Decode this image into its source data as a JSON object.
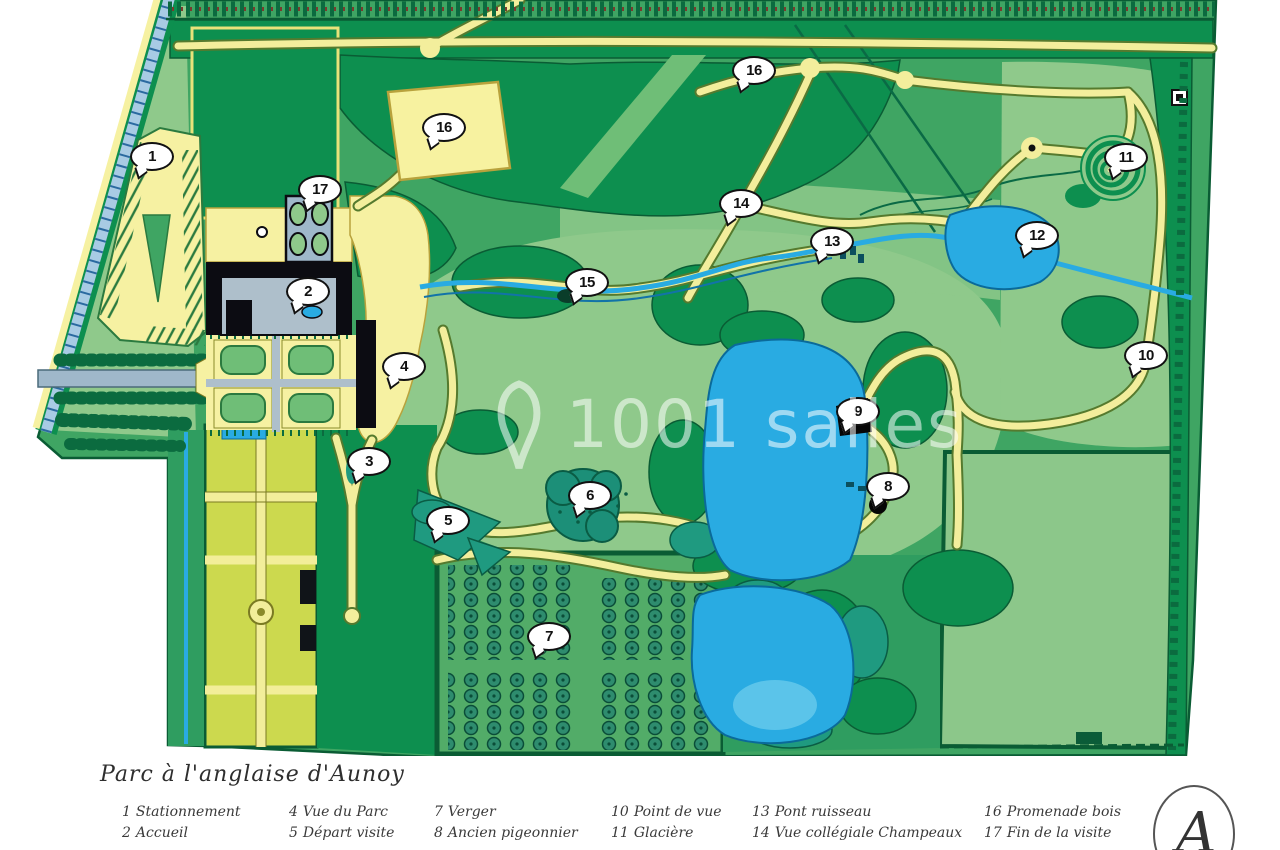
{
  "watermark": {
    "text": "1001 salles",
    "icon": "location-pin"
  },
  "legend": {
    "title": "Parc à l'anglaise d'Aunoy",
    "columns": [
      {
        "items": [
          {
            "num": "1",
            "label": "Stationnement"
          },
          {
            "num": "2",
            "label": "Accueil"
          }
        ]
      },
      {
        "items": [
          {
            "num": "4",
            "label": "Vue du Parc"
          },
          {
            "num": "5",
            "label": "Départ visite"
          }
        ]
      },
      {
        "items": [
          {
            "num": "7",
            "label": "Verger"
          },
          {
            "num": "8",
            "label": "Ancien pigeonnier"
          }
        ]
      },
      {
        "items": [
          {
            "num": "10",
            "label": "Point de vue"
          },
          {
            "num": "11",
            "label": "Glacière"
          }
        ]
      },
      {
        "items": [
          {
            "num": "13",
            "label": "Pont ruisseau"
          },
          {
            "num": "14",
            "label": "Vue collégiale Champeaux"
          }
        ]
      },
      {
        "items": [
          {
            "num": "16",
            "label": "Promenade bois"
          },
          {
            "num": "17",
            "label": "Fin de la visite"
          }
        ]
      }
    ]
  },
  "logo": {
    "letter": "A"
  },
  "markers": [
    {
      "num": "1",
      "x": 152,
      "y": 157
    },
    {
      "num": "16",
      "x": 444,
      "y": 128
    },
    {
      "num": "17",
      "x": 320,
      "y": 190
    },
    {
      "num": "16",
      "x": 754,
      "y": 71
    },
    {
      "num": "14",
      "x": 741,
      "y": 204
    },
    {
      "num": "13",
      "x": 832,
      "y": 242
    },
    {
      "num": "12",
      "x": 1037,
      "y": 236
    },
    {
      "num": "11",
      "x": 1126,
      "y": 158
    },
    {
      "num": "15",
      "x": 587,
      "y": 283
    },
    {
      "num": "2",
      "x": 308,
      "y": 292
    },
    {
      "num": "4",
      "x": 404,
      "y": 367
    },
    {
      "num": "10",
      "x": 1146,
      "y": 356
    },
    {
      "num": "9",
      "x": 858,
      "y": 412
    },
    {
      "num": "3",
      "x": 369,
      "y": 462
    },
    {
      "num": "8",
      "x": 888,
      "y": 487
    },
    {
      "num": "6",
      "x": 590,
      "y": 496
    },
    {
      "num": "5",
      "x": 448,
      "y": 521
    },
    {
      "num": "7",
      "x": 549,
      "y": 637
    }
  ],
  "colors": {
    "water": "#29abe2",
    "path_yellow": "#f6f1a2",
    "woods_dark": "#0d8f4f",
    "meadow_light": "#8fc98b",
    "green_mid": "#3fa563",
    "teal_trees": "#1f9a80",
    "parterre_yellow": "#ccd94e",
    "road_blue": "#7fb8dc",
    "marker_outline": "#111111"
  }
}
